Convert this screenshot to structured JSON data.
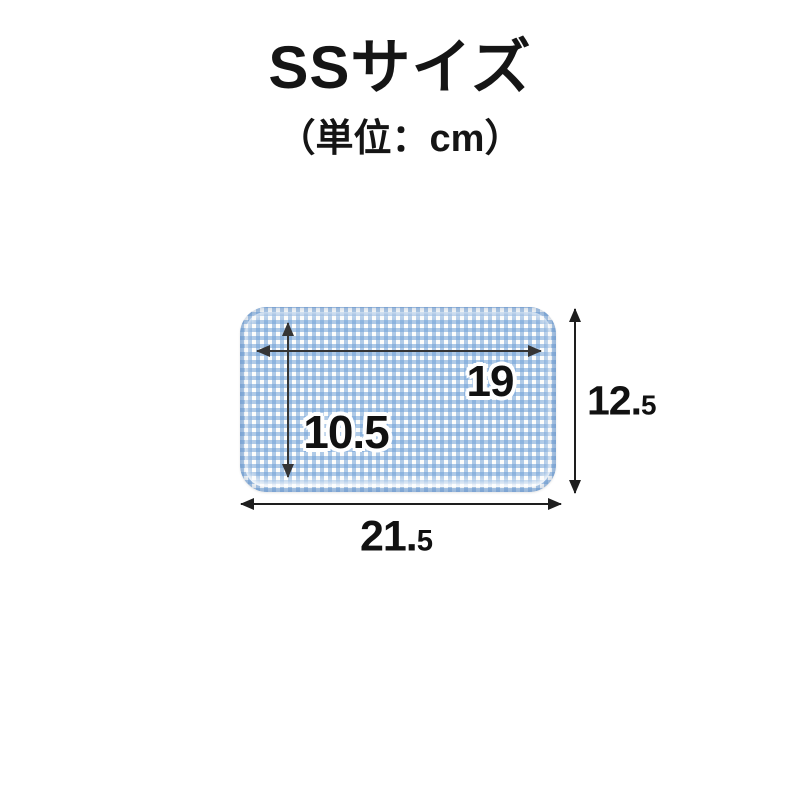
{
  "header": {
    "title": "SSサイズ",
    "subtitle": "（単位：cm）"
  },
  "diagram": {
    "product": "gingham-pattern-tray",
    "dimensions": {
      "inner_width": "19",
      "inner_depth": "10.5",
      "outer_depth_main": "12.",
      "outer_depth_small": "5",
      "outer_width_main": "21.",
      "outer_width_small": "5"
    },
    "colors": {
      "background": "#ffffff",
      "gingham_blue": "#6fa0d7",
      "arrow_inner": "#353535",
      "arrow_outer": "#1e1e1e",
      "label_text": "#111111",
      "label_halo": "#ffffff"
    }
  }
}
